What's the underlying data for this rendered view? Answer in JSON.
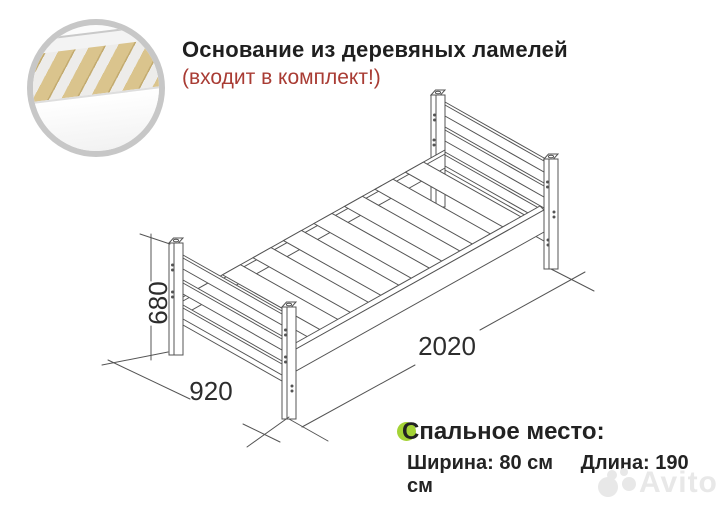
{
  "header": {
    "title": "Основание из деревяных ламелей",
    "subtitle": "(входит в комплект!)",
    "title_color": "#1f1f1f",
    "subtitle_color": "#a93c34"
  },
  "inset": {
    "icon": "wooden-slats-closeup-photo",
    "ring_color": "#c7c7c7",
    "slat_color": "#dac48d"
  },
  "drawing": {
    "dim_height": "680",
    "dim_width": "920",
    "dim_length": "2020",
    "line_color": "#545454",
    "text_color": "#2d2d2d"
  },
  "sleeping_area": {
    "heading": "Спальное место:",
    "width_label": "Ширина: 80 см",
    "length_label": "Длина: 190 см",
    "highlight_color": "#a4d336"
  },
  "watermark": {
    "text": "Avito",
    "color": "#e8e8e8"
  }
}
